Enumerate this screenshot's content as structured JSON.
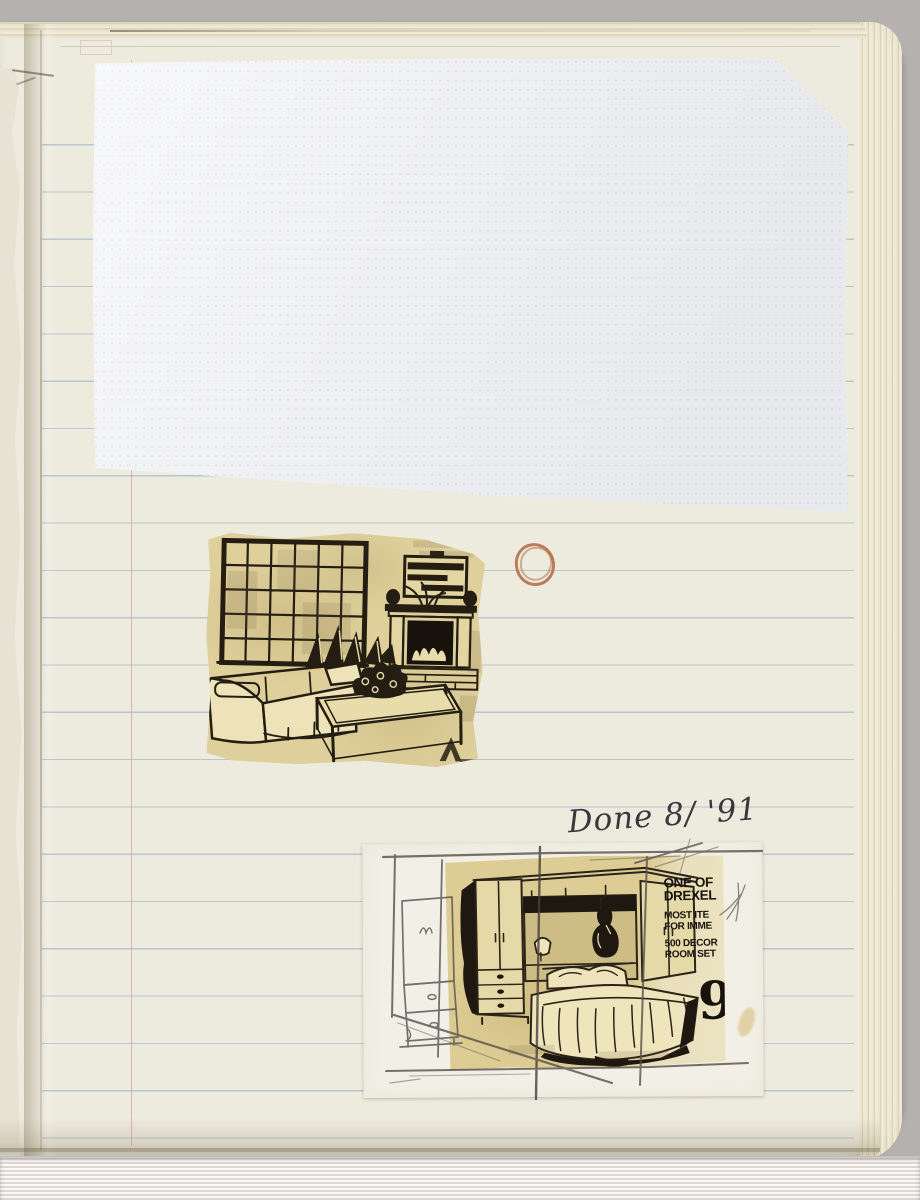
{
  "annotation": {
    "text": "Done 8/ '91"
  },
  "bedroom_ad": {
    "lines": [
      "ONE OF",
      "DREXEL",
      "MOST ITE",
      "FOR IMME",
      "500 DECOR",
      "ROOM SET"
    ],
    "price_digit": "9"
  },
  "colors": {
    "photo-bg": "#b5b1ae",
    "page": "#edeade",
    "page-edge": "#ddd5ba",
    "rule-blue": "#9db8d2",
    "margin-red": "#c98f9a",
    "graph-paper": "#f0f1f4",
    "clipping-yellow": "#decf9b",
    "ink": "#241d12",
    "pencil": "#55514a",
    "circle-mark": "#b26a42",
    "backing-white": "#f2efe6",
    "fabric": "#eae8e4"
  }
}
